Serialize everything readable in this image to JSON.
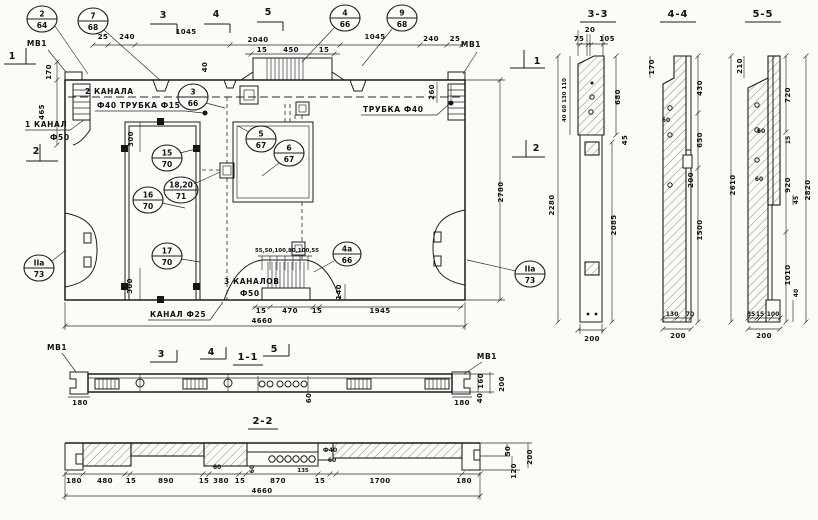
{
  "titles": {
    "s11": "1-1",
    "s22": "2-2",
    "s33": "3-3",
    "s44": "4-4",
    "s55": "5-5"
  },
  "marks": {
    "one": "1",
    "two": "2",
    "three": "3",
    "four": "4",
    "five": "5"
  },
  "notes": {
    "mv1": "МВ1",
    "two_channels": "2 КАНАЛА",
    "tube_row": "Ф40 ТРУБКА Ф15",
    "one_channel": "1 КАНАЛ",
    "one_channel_d": "Ф50",
    "tube40": "ТРУБКА Ф40",
    "three_channels": "3 КАНАЛОВ",
    "three_channels_d": "Ф50",
    "channel25": "КАНАЛ Ф25"
  },
  "callouts": [
    {
      "num": "2",
      "den": "64"
    },
    {
      "num": "7",
      "den": "68"
    },
    {
      "num": "4",
      "den": "66"
    },
    {
      "num": "9",
      "den": "68"
    },
    {
      "num": "3",
      "den": "66"
    },
    {
      "num": "5",
      "den": "67"
    },
    {
      "num": "6",
      "den": "67"
    },
    {
      "num": "15",
      "den": "70"
    },
    {
      "num": "18,20",
      "den": "71"
    },
    {
      "num": "16",
      "den": "70"
    },
    {
      "num": "17",
      "den": "70"
    },
    {
      "num": "4а",
      "den": "66"
    },
    {
      "num": "IIа",
      "den": "73"
    },
    {
      "num": "IIа",
      "den": "73"
    }
  ],
  "dims": {
    "top": [
      "25",
      "240",
      "1045",
      "2040",
      "15",
      "450",
      "15",
      "40",
      "1045",
      "240",
      "25"
    ],
    "left": [
      "170",
      "465"
    ],
    "right_panel": [
      "260",
      "2780"
    ],
    "door": [
      "300",
      "300"
    ],
    "hump": [
      "55,50,100,80,100,55",
      "140"
    ],
    "bottom": [
      "15",
      "470",
      "15",
      "1945",
      "4660"
    ],
    "s11": [
      "180",
      "60",
      "180",
      "160",
      "40",
      "200"
    ],
    "s22": [
      "180",
      "480",
      "15",
      "890",
      "15",
      "60",
      "380",
      "15",
      "60",
      "870",
      "135",
      "15",
      "1700",
      "180",
      "Ф40",
      "60",
      "50",
      "200",
      "120",
      "4660"
    ],
    "s33": [
      "75",
      "20",
      "105",
      "40 60 130 110",
      "680",
      "45",
      "2280",
      "2085",
      "200"
    ],
    "s44": [
      "170",
      "430",
      "60",
      "650",
      "200",
      "1500",
      "2610",
      "130",
      "70",
      "200"
    ],
    "s55": [
      "210",
      "720",
      "15",
      "60",
      "920",
      "60",
      "45",
      "1010",
      "40",
      "2820",
      "85",
      "15",
      "100",
      "200"
    ]
  }
}
